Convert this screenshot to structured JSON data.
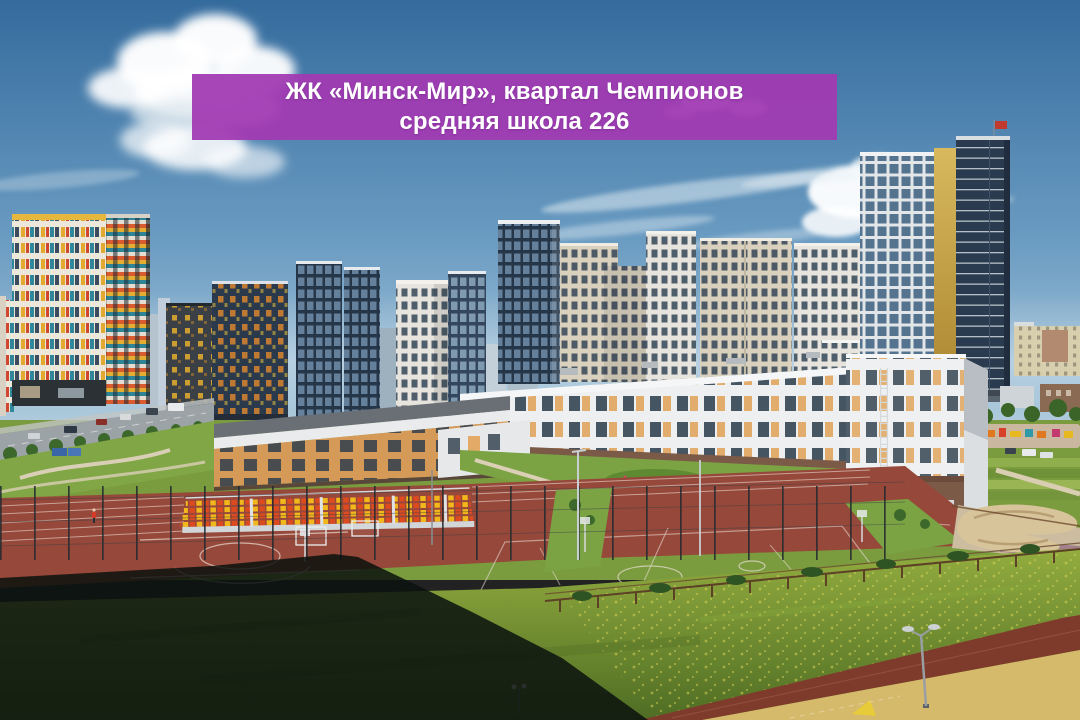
{
  "banner": {
    "line1": "ЖК «Минск-Мир», квартал Чемпионов",
    "line2": "средняя школа 226",
    "background_color": "#a23ab2",
    "text_color": "#ffffff"
  },
  "photo_palette": {
    "sky_top": "#346b9d",
    "sky_horizon": "#b5cfdf",
    "school_facade": "#edeff0",
    "school_panel_orange": "#e2aa66",
    "school_brick_base": "#7c5a48",
    "court_red": "#96483a",
    "grass_green": "#7ba344",
    "track_red": "#7e3b2c",
    "bleacher_yellow": "#f2b71b",
    "bleacher_red": "#de4a20",
    "landmark_gold": "#c9a84c",
    "shadow": "#0a120e"
  }
}
